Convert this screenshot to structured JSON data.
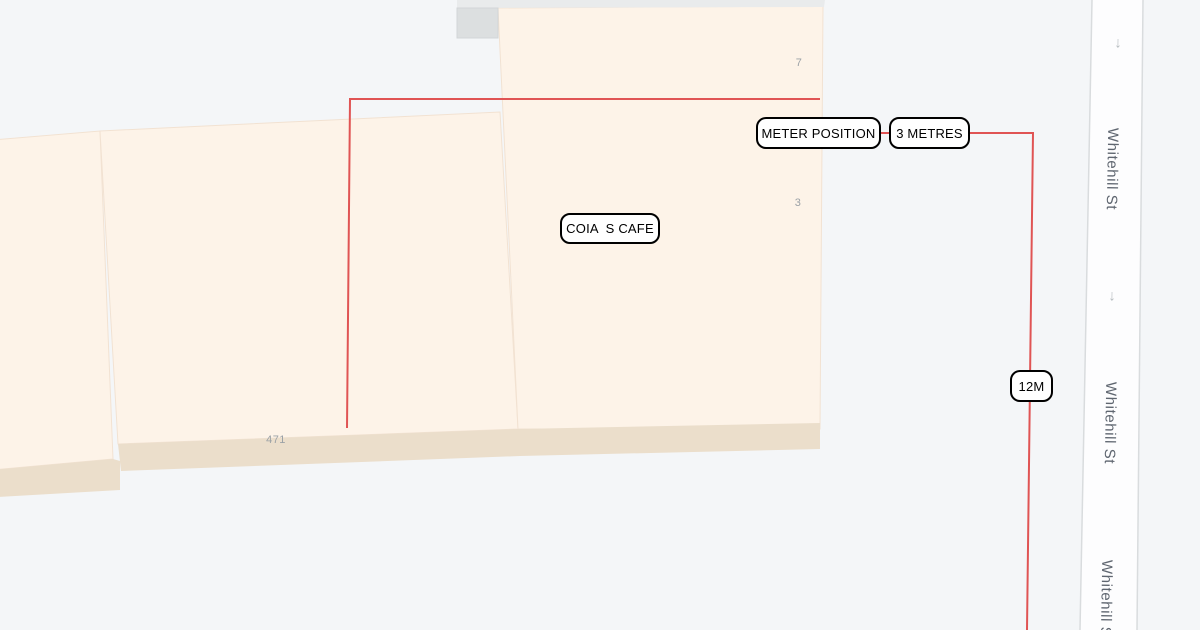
{
  "map": {
    "colors": {
      "background": "#f4f6f8",
      "building_fill": "#fdf3e8",
      "building_edge": "#f2e2d2",
      "building_base": "#ebdecb",
      "building_gray_strip": "#e9ebec",
      "building_gray_block": "#dcdfe0",
      "road_fill": "#fdfdfe",
      "road_border": "#d9dcde",
      "annotation_line": "#e05454",
      "annotation_box_border": "#000000",
      "annotation_box_fill": "#ffffff",
      "street_text": "#5f6670",
      "number_text": "#9ba1a6"
    },
    "street": {
      "name": "Whitehill St",
      "labels": [
        {
          "text": "Whitehill St"
        },
        {
          "text": "Whitehill St"
        },
        {
          "text": "Whitehill St"
        }
      ],
      "direction_arrows": [
        {
          "glyph": "↓"
        },
        {
          "glyph": "↓"
        }
      ]
    },
    "building_numbers": [
      {
        "text": "7"
      },
      {
        "text": "3"
      },
      {
        "text": "471"
      }
    ],
    "annotations": {
      "meter_position": "METER POSITION",
      "distance_1": "3 METRES",
      "cafe_name": "COIA  S CAFE",
      "distance_2": "12M"
    }
  }
}
